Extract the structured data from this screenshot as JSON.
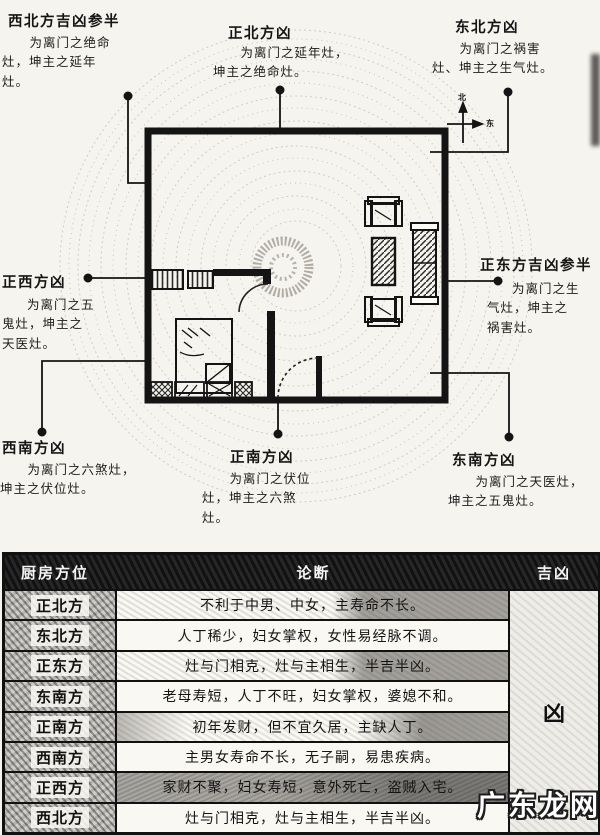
{
  "diagram": {
    "compass": {
      "north_label": "北",
      "east_label": "东"
    },
    "labels": {
      "northwest": {
        "title": "西北方吉凶参半",
        "desc": "为离门之绝命灶，坤主之延年灶。"
      },
      "north": {
        "title": "正北方凶",
        "desc": "为离门之延年灶，坤主之绝命灶。"
      },
      "northeast": {
        "title": "东北方凶",
        "desc": "为离门之祸害灶、坤主之生气灶。"
      },
      "west": {
        "title": "正西方凶",
        "desc": "为离门之五鬼灶，坤主之天医灶。"
      },
      "east": {
        "title": "正东方吉凶参半",
        "desc": "为离门之生气灶，坤主之祸害灶。"
      },
      "southwest": {
        "title": "西南方凶",
        "desc": "为离门之六煞灶，坤主之伏位灶。"
      },
      "south": {
        "title": "正南方凶",
        "desc": "为离门之伏位灶，坤主之六煞灶。"
      },
      "southeast": {
        "title": "东南方凶",
        "desc": "为离门之天医灶，坤主之五鬼灶。"
      }
    }
  },
  "table": {
    "headers": [
      "厨房方位",
      "论断",
      "吉凶"
    ],
    "rows": [
      {
        "direction": "正北方",
        "judgment": "不利于中男、中女，主寿命不长。"
      },
      {
        "direction": "东北方",
        "judgment": "人丁稀少，妇女掌权，女性易经脉不调。"
      },
      {
        "direction": "正东方",
        "judgment": "灶与门相克，灶与主相生，半吉半凶。"
      },
      {
        "direction": "东南方",
        "judgment": "老母寿短，人丁不旺，妇女掌权，婆媳不和。"
      },
      {
        "direction": "正南方",
        "judgment": "初年发财，但不宜久居，主缺人丁。"
      },
      {
        "direction": "西南方",
        "judgment": "主男女寿命不长，无子嗣，易患疾病。"
      },
      {
        "direction": "正西方",
        "judgment": "家财不聚，妇女寿短，意外死亡，盗贼入宅。"
      },
      {
        "direction": "西北方",
        "judgment": "灶与门相克，灶与主相生，半吉半凶。"
      }
    ],
    "verdict": "凶"
  },
  "watermark": "广东龙网",
  "colors": {
    "ink": "#111111",
    "header_bg": "#171717",
    "scan_gray": "#b5b2ab"
  }
}
